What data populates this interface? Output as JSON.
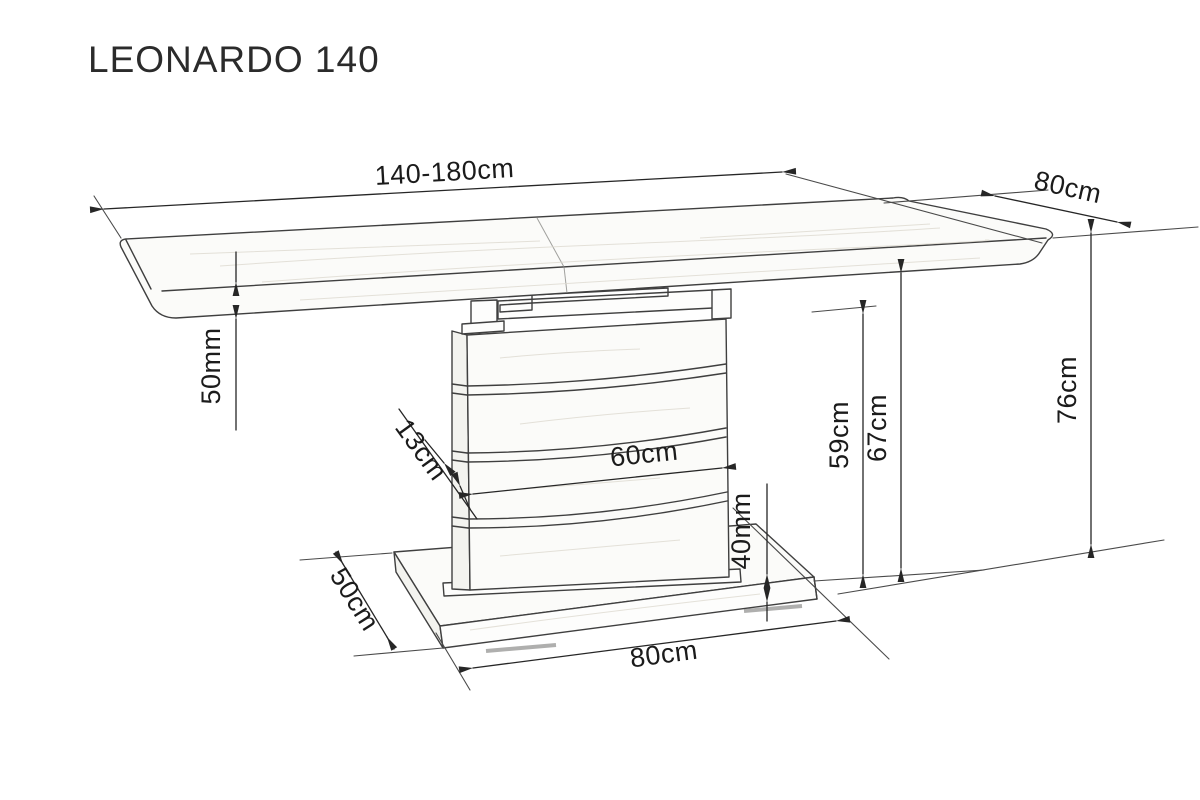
{
  "title": "LEONARDO 140",
  "colors": {
    "background": "#ffffff",
    "outline": "#3f3f3f",
    "dimension_lines": "#262626",
    "text": "#1b1b1b"
  },
  "dimensions": {
    "top_length": {
      "label": "140-180cm"
    },
    "top_depth": {
      "label": "80cm"
    },
    "top_thickness": {
      "label": "50mm"
    },
    "slat_height": {
      "label": "13cm"
    },
    "column_width": {
      "label": "60cm"
    },
    "column_height": {
      "label": "59cm"
    },
    "clearance_height": {
      "label": "67cm"
    },
    "total_height": {
      "label": "76cm"
    },
    "base_thickness": {
      "label": "40mm"
    },
    "base_depth": {
      "label": "50cm"
    },
    "base_width": {
      "label": "80cm"
    }
  }
}
